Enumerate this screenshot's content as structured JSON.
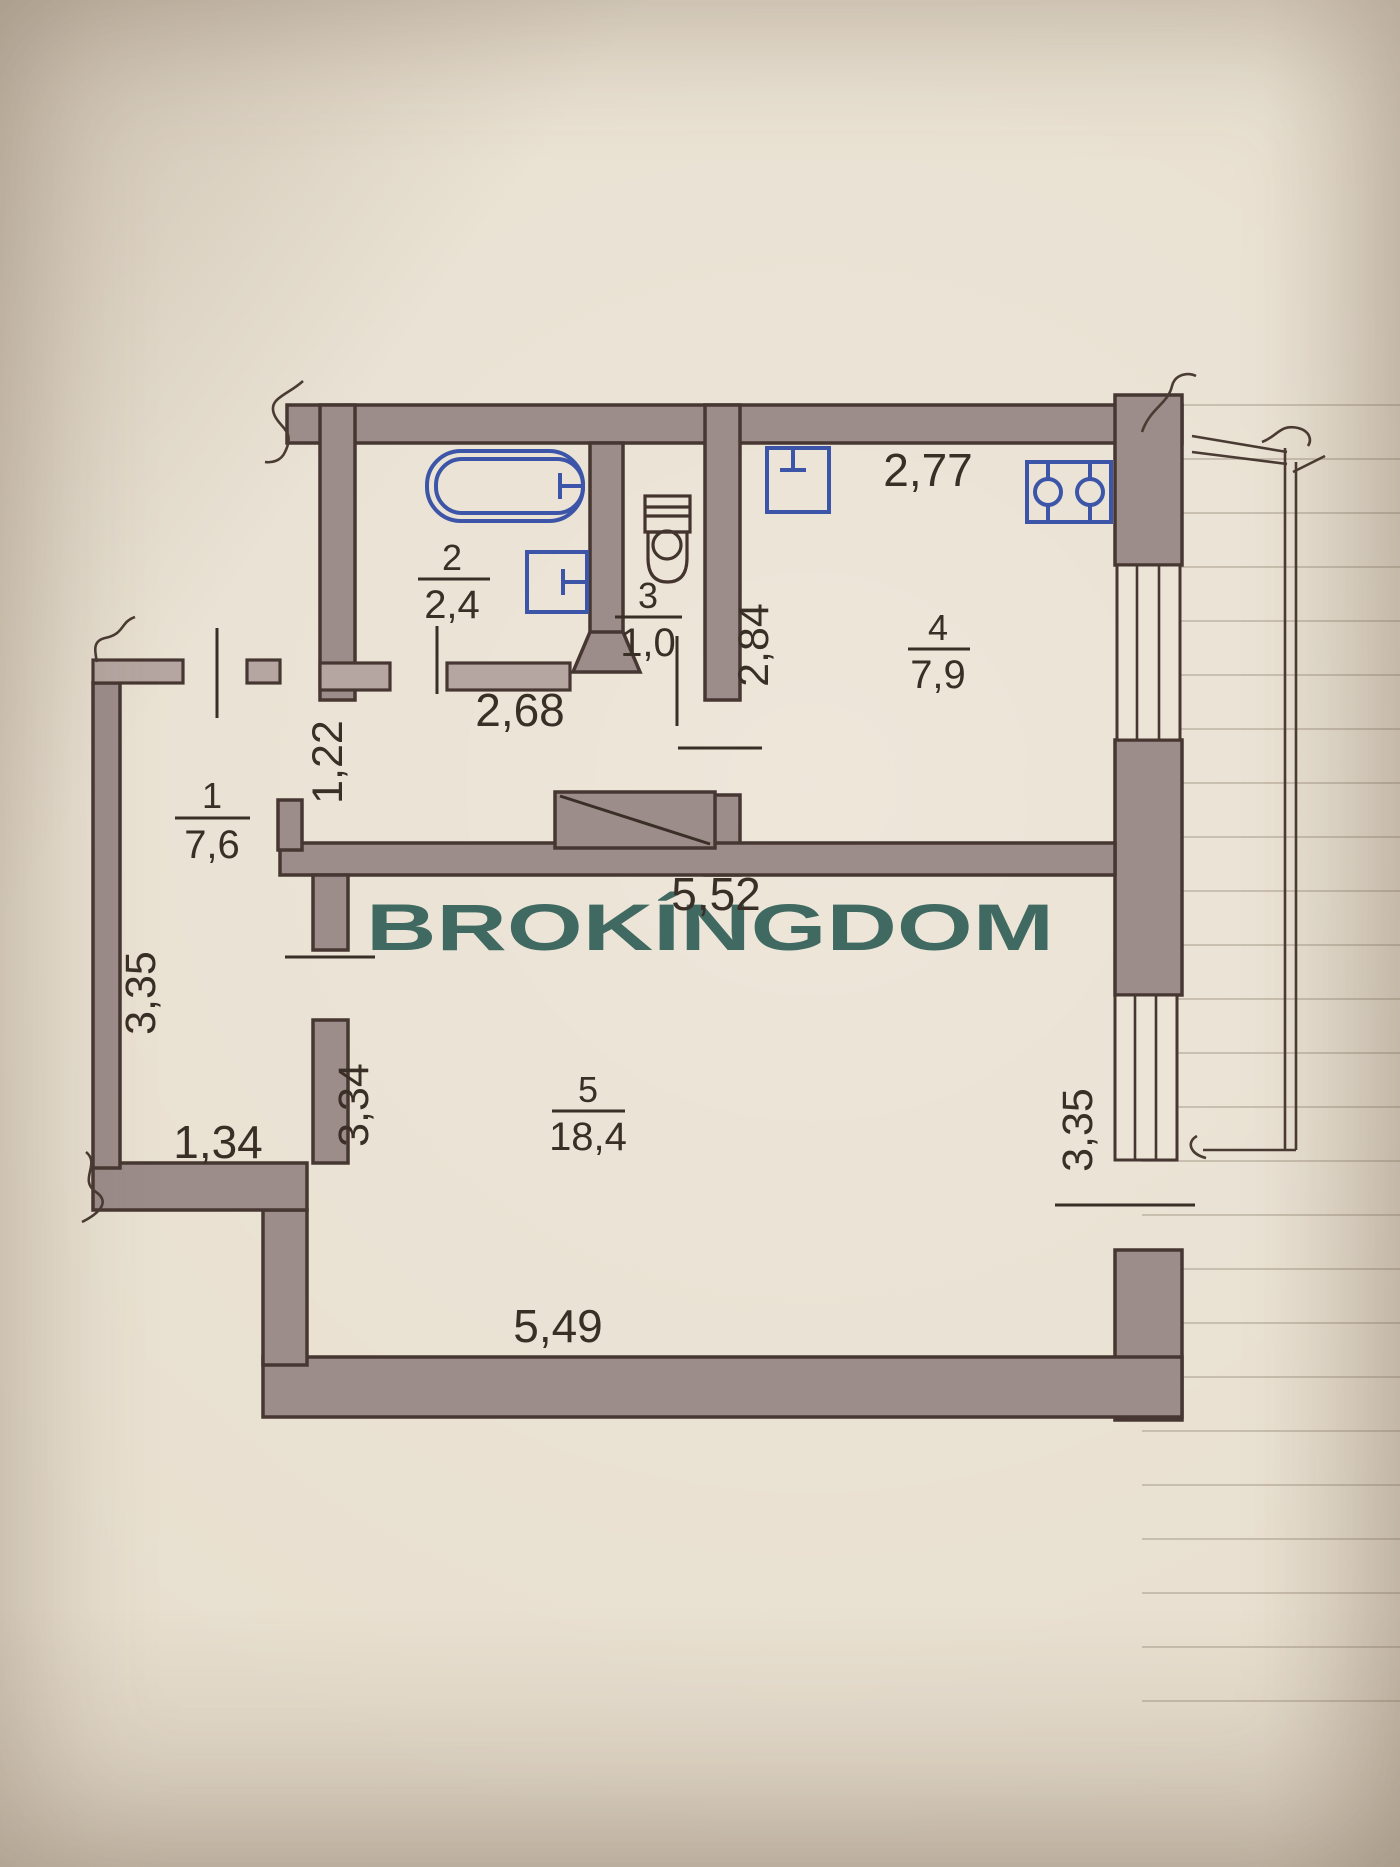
{
  "watermark": {
    "text": "BROKÍNGDOM",
    "color": "#2d5c55"
  },
  "plan": {
    "rooms": [
      {
        "id": "hallway",
        "number": "1",
        "area": "7,6"
      },
      {
        "id": "bathroom",
        "number": "2",
        "area": "2,4"
      },
      {
        "id": "wc",
        "number": "3",
        "area": "1,0"
      },
      {
        "id": "kitchen",
        "number": "4",
        "area": "7,9"
      },
      {
        "id": "living-room",
        "number": "5",
        "area": "18,4"
      }
    ],
    "dimensions": {
      "kitchen_width": "2,77",
      "kitchen_depth": "2,84",
      "corridor_width": "2,68",
      "corridor_depth": "1,22",
      "living_width_top": "5,52",
      "living_width_bottom": "5,49",
      "living_depth_left": "3,34",
      "living_depth_right": "3,35",
      "hall_depth": "3,35",
      "hall_width": "1,34"
    },
    "colors": {
      "wall_fill": "#9c8c8a",
      "wall_outline": "#473732",
      "fixture_blue": "#3c55a8",
      "paper": "#e8dfcf",
      "text": "#3a2f26"
    }
  }
}
